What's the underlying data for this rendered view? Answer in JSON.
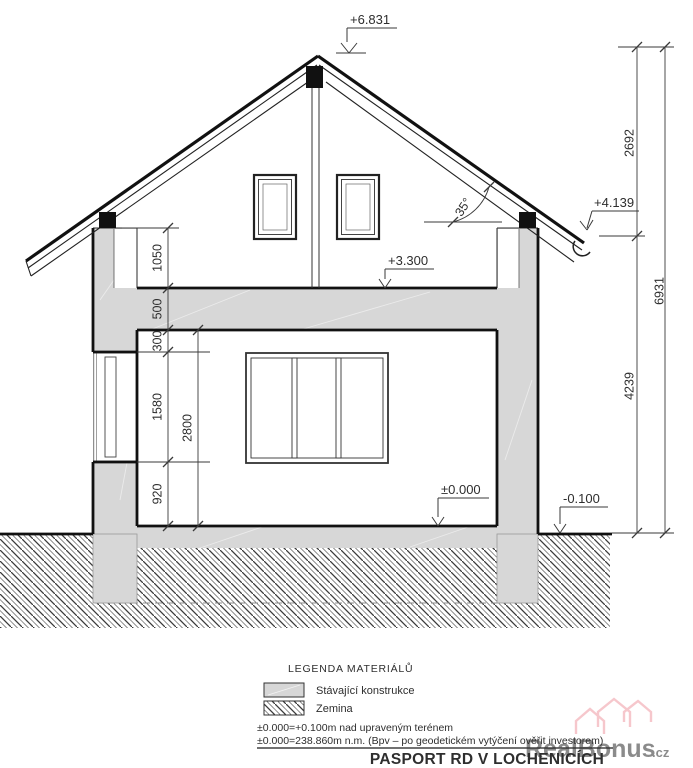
{
  "title": "PASPORT RD V LOCHENICÍCH",
  "levels": {
    "ridge": "+6.831",
    "eave": "+4.139",
    "attic_floor": "+3.300",
    "ground_floor": "±0.000",
    "terrain": "-0.100"
  },
  "roof": {
    "pitch_label": "35°"
  },
  "dimensions": {
    "left": [
      "1050",
      "500",
      "300",
      "1580",
      "920"
    ],
    "left_total": "2800",
    "right": [
      "2692",
      "4239"
    ],
    "right_total": "6931"
  },
  "legend": {
    "heading": "LEGENDA MATERIÁLŮ",
    "items": [
      {
        "label": "Stávající konstrukce",
        "swatch": "solid-gray"
      },
      {
        "label": "Zemina",
        "swatch": "hatch"
      }
    ]
  },
  "notes": [
    "±0.000=+0.100m nad upraveným terénem",
    "±0.000=238.860m n.m. (Bpv – po geodetickém vytýčení ověřit investorem)"
  ],
  "watermark": {
    "text": "RealBonus",
    "tld": ".cz"
  },
  "colors": {
    "construction_fill": "#d7d7d7",
    "line": "#1c1c1c",
    "dimension": "#3a3a3a",
    "watermark": "#ef9aa4"
  }
}
